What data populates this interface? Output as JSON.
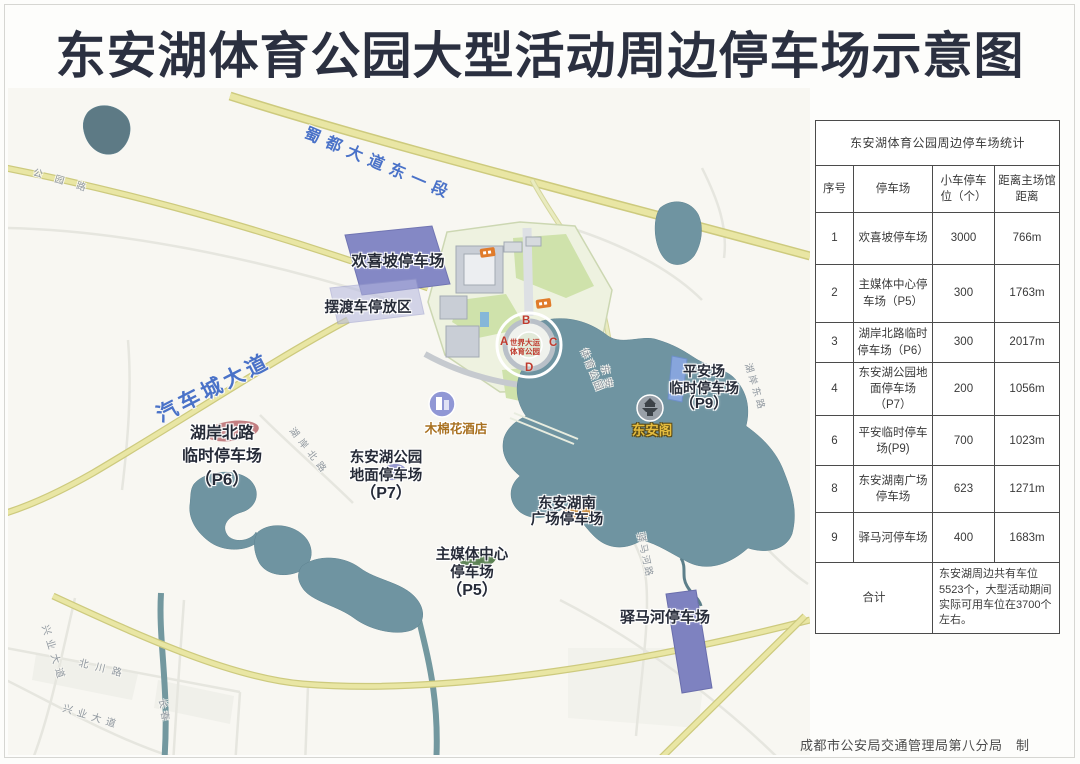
{
  "title": "东安湖体育公园大型活动周边停车场示意图",
  "credit": "成都市公安局交通管理局第八分局　制",
  "table": {
    "title": "东安湖体育公园周边停车场统计",
    "headers": {
      "no": "序号",
      "lot": "停车场",
      "spaces": "小车停车位（个）",
      "distance": "距离主场馆距离"
    },
    "rows": [
      {
        "no": "1",
        "lot": "欢喜坡停车场",
        "spaces": "3000",
        "distance": "766m"
      },
      {
        "no": "2",
        "lot": "主媒体中心停车场（P5）",
        "spaces": "300",
        "distance": "1763m"
      },
      {
        "no": "3",
        "lot": "湖岸北路临时停车场（P6）",
        "spaces": "300",
        "distance": "2017m"
      },
      {
        "no": "4",
        "lot": "东安湖公园地面停车场（P7）",
        "spaces": "200",
        "distance": "1056m"
      },
      {
        "no": "6",
        "lot": "平安临时停车场(P9)",
        "spaces": "700",
        "distance": "1023m"
      },
      {
        "no": "8",
        "lot": "东安湖南广场停车场",
        "spaces": "623",
        "distance": "1271m"
      },
      {
        "no": "9",
        "lot": "驿马河停车场",
        "spaces": "400",
        "distance": "1683m"
      }
    ],
    "total_label": "合计",
    "total_note": "东安湖周边共有车位5523个，大型活动期间实际可用车位在3700个左右。"
  },
  "map": {
    "road_labels": {
      "shudu": "蜀都大道东一段",
      "qichecheng": "汽车城大道",
      "gongyuanlu": "公园路",
      "huanbei": "湖岸北路",
      "huandong": "湖岸东路",
      "dongan": "东安",
      "yimahelu": "驿马河路",
      "tiyu": "体育公园",
      "beichuan": "北川路",
      "xingye1": "兴业大道",
      "xingye2": "兴业大道",
      "changchun": "长春"
    },
    "lots": {
      "huanxipo": "欢喜坡停车场",
      "ferry": "摆渡车停放区",
      "p6": {
        "l1": "湖岸北路",
        "l2": "临时停车场",
        "l3": "（P6）"
      },
      "p7": {
        "l1": "东安湖公园",
        "l2": "地面停车场",
        "l3": "（P7）"
      },
      "p5": {
        "l1": "主媒体中心",
        "l2": "停车场",
        "l3": "（P5）"
      },
      "south": {
        "l1": "东安湖南",
        "l2": "广场停车场"
      },
      "p9": {
        "l1": "平安场",
        "l2": "临时停车场",
        "l3": "（P9）"
      },
      "yimahe": "驿马河停车场"
    },
    "pois": {
      "hotel": "木棉花酒店",
      "dongange": "东安阁"
    },
    "stadium": {
      "core_l1": "世界大运",
      "core_l2": "体育公园",
      "gates": [
        "A",
        "B",
        "C",
        "D"
      ]
    }
  },
  "colors": {
    "title_text": "#2b3040",
    "road_label_blue": "#4a72c8",
    "lot_label": "#262b38",
    "parking_block_purple": "#8488c5",
    "water_teal": "#6f94a1",
    "road_yellow": "#e9e6a4",
    "stadium_core_red": "#c03a2e",
    "hotel_label": "#a8701f",
    "dongange_label": "#e6bd3e",
    "table_border": "#4b4b4b"
  }
}
